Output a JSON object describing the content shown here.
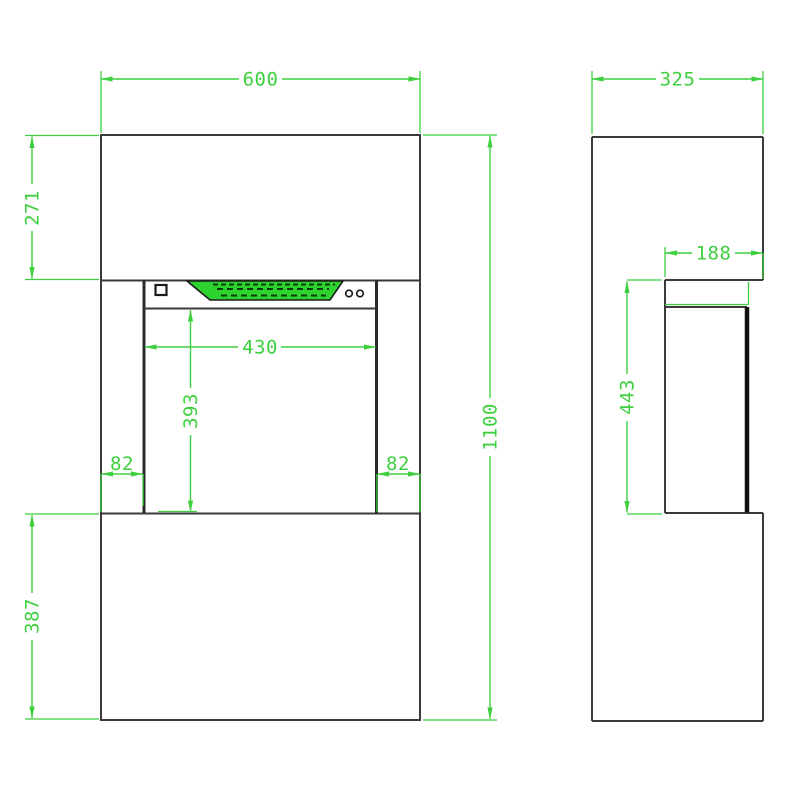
{
  "colors": {
    "dimension_green": "#3ecf3e",
    "outline_dark": "#3a3a3a",
    "display_green": "#2fd330",
    "background": "#ffffff"
  },
  "dimensions": {
    "front_width": "600",
    "front_top_height": "271",
    "front_total_height": "1100",
    "front_bottom_height": "387",
    "opening_width": "430",
    "opening_height": "393",
    "offset_left": "82",
    "offset_right": "82",
    "side_depth": "325",
    "recess_depth": "188",
    "recess_height": "443"
  }
}
